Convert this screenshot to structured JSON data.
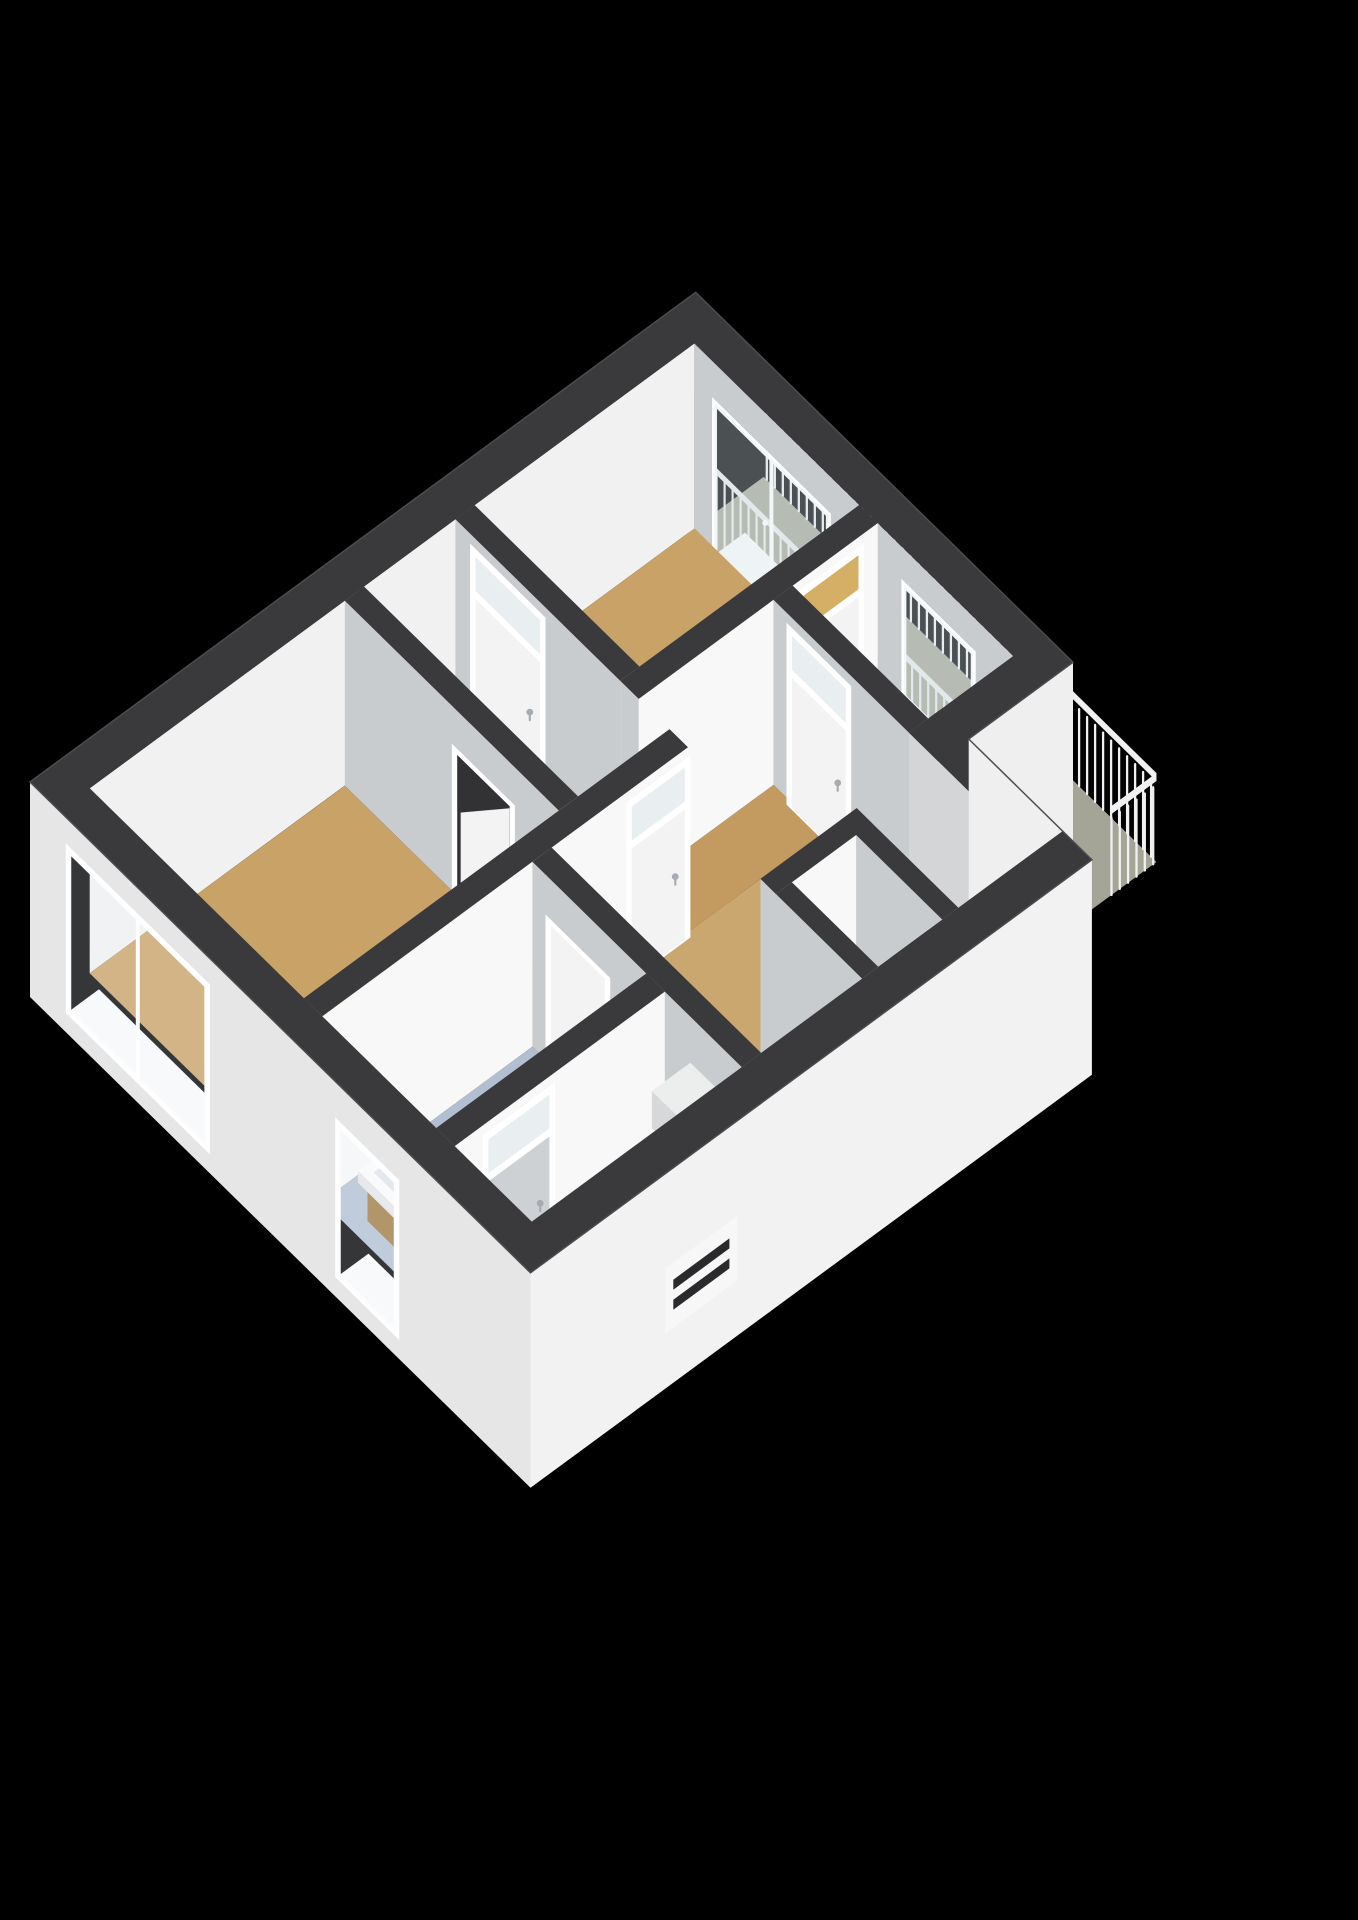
{
  "app": {
    "name": "3d-floorplan-isometric-view"
  },
  "canvas": {
    "width": 1358,
    "height": 1920,
    "background": "#000000"
  },
  "iso": {
    "x0": 30,
    "y0": 782,
    "ax": 0.802,
    "ay": -0.59,
    "bx": 0.77,
    "by": 0.755,
    "floorZ": 185,
    "baseZ": 215,
    "sillZ": 192,
    "balconyFloorZ": 195,
    "railTopZ": 112
  },
  "palette": {
    "bg": "#000000",
    "wallTop": "#3a3a3c",
    "outline": "#4c4c50",
    "extSW": "#e6e6e6",
    "extSE": "#f2f2f2",
    "extSE2": "#efefef",
    "intSE": "#f8f8f8",
    "intSW": "#c9ccce",
    "intSW2": "#d3d5d6",
    "intNW": "#f1f1f2",
    "wood": "#c9a267",
    "woodHall": "#c39b60",
    "woodKitchen": "#c9a76e",
    "tile": "#b2bfd3",
    "whiteFloor": "#f1f1f1",
    "closetFloor": "#9b9b9d",
    "balconyFloor": "#a5a597",
    "railing": "#f1f1f1",
    "railing2": "#e9eceb",
    "frame": "#ffffff",
    "sill": "#fafafa",
    "glassNE": "rgba(214,228,235,0.35)",
    "glassSW": "rgba(240,246,250,0.22)",
    "transomGlass": "#e9eef1",
    "amber": "#d6af67",
    "doorWhite": "#f3f3f3",
    "doorGray": "#cdd1d4",
    "gap": "#323235",
    "oak": "#b78b50",
    "oakDark": "#a17a41",
    "chrome": "#a6acb1",
    "boxWhite": "#eceded",
    "slabSlot": "#2a2a2c"
  },
  "plan": {
    "outline": [
      [
        0,
        0
      ],
      [
        830,
        0
      ],
      [
        830,
        490
      ],
      [
        700,
        490
      ],
      [
        700,
        650
      ],
      [
        0,
        650
      ]
    ],
    "ringT": 38,
    "floors": [
      {
        "name": "floor-bedroom-1",
        "rect": [
          518,
          38,
          792,
          252
        ],
        "color": "wood"
      },
      {
        "name": "floor-study",
        "rect": [
          686,
          276,
          792,
          452
        ],
        "color": "whiteFloor"
      },
      {
        "name": "floor-hall",
        "rect": [
          380,
          38,
          494,
          316
        ],
        "color": "woodHall"
      },
      {
        "name": "floor-hall-b",
        "rect": [
          494,
          276,
          662,
          340
        ],
        "color": "woodHall"
      },
      {
        "name": "floor-living-room",
        "rect": [
          38,
          38,
          356,
          316
        ],
        "color": "wood"
      },
      {
        "name": "floor-kitchen",
        "rect": [
          324,
          340,
          662,
          612
        ],
        "color": "woodKitchen"
      },
      {
        "name": "floor-washroom",
        "rect": [
          38,
          340,
          300,
          488
        ],
        "color": "tile"
      },
      {
        "name": "floor-shower-room",
        "rect": [
          38,
          512,
          300,
          612
        ],
        "color": "tile"
      },
      {
        "name": "floor-closet",
        "rect": [
          470,
          500,
          550,
          612
        ],
        "color": "closetFloor"
      }
    ],
    "sills": [
      {
        "name": "sill-living-window",
        "rect": [
          0,
          50,
          38,
          230
        ]
      },
      {
        "name": "sill-washroom-window",
        "rect": [
          0,
          400,
          38,
          476
        ]
      },
      {
        "name": "sill-balcony-door",
        "rect": [
          792,
          64,
          830,
          212
        ]
      },
      {
        "name": "sill-study-window",
        "rect": [
          792,
          310,
          830,
          400
        ]
      }
    ],
    "neRing": {
      "name": "wall-exterior-ne",
      "faceU": 792,
      "v0": 38,
      "v1": 452,
      "holes": [
        {
          "name": "balcony-door-opening",
          "a0": 64,
          "a1": 212,
          "z0": 40,
          "z1": 190,
          "mullion": 138
        },
        {
          "name": "study-window-opening",
          "a0": 310,
          "a1": 400,
          "z0": 36,
          "z1": 148,
          "mullion": null
        }
      ],
      "top": [
        792,
        0,
        830,
        490
      ]
    },
    "nwRing": {
      "name": "wall-exterior-nw",
      "faceV": 38,
      "u0": 38,
      "u1": 792,
      "top": [
        0,
        0,
        830,
        38
      ]
    },
    "seRingEast": {
      "name": "wall-exterior-se-east",
      "top": [
        662,
        452,
        830,
        490
      ],
      "faceV": 490,
      "u0": 700,
      "u1": 830
    },
    "seRingDeep": {
      "name": "wall-exterior-se-deep",
      "top": [
        0,
        612,
        700,
        650
      ],
      "faceV": 650,
      "u0": 0,
      "u1": 700
    },
    "swRing": {
      "name": "wall-exterior-sw",
      "top": [
        0,
        0,
        38,
        650
      ],
      "faceU": 0,
      "v0": 0,
      "v1": 650,
      "holes": [
        {
          "name": "living-window-opening",
          "a0": 50,
          "a1": 230,
          "z0": 30,
          "z1": 192,
          "mullion": 140
        },
        {
          "name": "washroom-window-opening",
          "a0": 400,
          "a1": 476,
          "z0": 40,
          "z1": 192,
          "mullion": null
        }
      ]
    },
    "walls": [
      {
        "name": "wall-bedroom1-hall",
        "top": [
          494,
          38,
          518,
          252
        ],
        "faces": [
          {
            "k": "f2",
            "c": 494,
            "a0": 38,
            "a1": 252,
            "fill": "intSW"
          },
          {
            "k": "f1",
            "c": 252,
            "a0": 494,
            "a1": 518,
            "fill": "intSE"
          }
        ],
        "doors": [
          {
            "face": "f2",
            "c": 494,
            "a0": 64,
            "a1": 148,
            "leaf": "doorWhite",
            "transom": "transomGlass",
            "handle": 0.84
          }
        ]
      },
      {
        "name": "wall-bedroom1-south",
        "top": [
          494,
          252,
          792,
          276
        ],
        "faces": [
          {
            "k": "f1",
            "c": 276,
            "a0": 494,
            "a1": 792,
            "fill": "intSE"
          },
          {
            "k": "f2",
            "c": 494,
            "a0": 252,
            "a1": 276,
            "fill": "intSW"
          }
        ],
        "doors": [
          {
            "face": "f1",
            "c": 276,
            "a0": 700,
            "a1": 768,
            "leaf": "doorWhite",
            "transom": "amber",
            "handle": 0.12
          }
        ]
      },
      {
        "name": "wall-study",
        "top": [
          662,
          276,
          686,
          452
        ],
        "faces": [
          {
            "k": "f2",
            "c": 662,
            "a0": 276,
            "a1": 452,
            "fill": "intSW"
          }
        ],
        "doors": [
          {
            "face": "f2",
            "c": 662,
            "a0": 300,
            "a1": 370,
            "leaf": "doorWhite",
            "transom": "transomGlass",
            "handle": 0.85
          }
        ]
      },
      {
        "name": "wall-living-hall",
        "top": [
          356,
          38,
          380,
          316
        ],
        "faces": [
          {
            "k": "f2",
            "c": 356,
            "a0": 38,
            "a1": 316,
            "fill": "intSW"
          },
          {
            "k": "f1",
            "c": 316,
            "a0": 356,
            "a1": 380,
            "fill": "intSE"
          }
        ],
        "openings": [
          {
            "face": "f2",
            "c": 356,
            "a0": 184,
            "a1": 252,
            "openLeaf": true
          }
        ]
      },
      {
        "name": "wall-notch-inner",
        "top": [
          662,
          452,
          700,
          650
        ],
        "faces": [
          {
            "k": "f2",
            "c": 662,
            "a0": 452,
            "a1": 612,
            "fill": "intSW2"
          }
        ]
      },
      {
        "name": "closet-wall-nw",
        "top": [
          450,
          480,
          570,
          500
        ],
        "faces": [
          {
            "k": "f1",
            "c": 500,
            "a0": 450,
            "a1": 570,
            "fill": "intSE"
          },
          {
            "k": "f2",
            "c": 450,
            "a0": 480,
            "a1": 500,
            "fill": "intSW"
          }
        ]
      },
      {
        "name": "closet-wall-ne",
        "top": [
          550,
          480,
          570,
          612
        ],
        "faces": [
          {
            "k": "f2",
            "c": 550,
            "a0": 500,
            "a1": 612,
            "fill": "intSW"
          }
        ]
      },
      {
        "name": "closet-wall-sw",
        "top": [
          450,
          500,
          470,
          612
        ],
        "faces": [
          {
            "k": "f2",
            "c": 450,
            "a0": 500,
            "a1": 612,
            "fill": "intSW"
          }
        ]
      },
      {
        "name": "wall-hall-kitchen",
        "top": [
          38,
          316,
          494,
          340
        ],
        "faces": [
          {
            "k": "f1",
            "c": 340,
            "a0": 38,
            "a1": 494,
            "fill": "intSE"
          }
        ],
        "doors": [
          {
            "face": "f1",
            "c": 340,
            "a0": 424,
            "a1": 490,
            "leaf": "doorWhite",
            "transom": "transomGlass",
            "handle": 0.82
          }
        ]
      },
      {
        "name": "wall-washroom-east",
        "top": [
          300,
          340,
          324,
          612
        ],
        "faces": [
          {
            "k": "f2",
            "c": 300,
            "a0": 340,
            "a1": 612,
            "fill": "intSW"
          }
        ],
        "doors": [
          {
            "face": "f2",
            "c": 300,
            "a0": 364,
            "a1": 434,
            "leaf": "doorWhite",
            "transom": null,
            "handle": 0.85
          }
        ]
      },
      {
        "name": "wall-washroom-divider",
        "top": [
          38,
          488,
          300,
          512
        ],
        "faces": [
          {
            "k": "f1",
            "c": 512,
            "a0": 38,
            "a1": 300,
            "fill": "intSE"
          }
        ],
        "doors": [
          {
            "face": "f1",
            "c": 512,
            "a0": 80,
            "a1": 156,
            "leaf": "doorGray",
            "transom": "transomGlass",
            "handle": 0.85
          }
        ]
      }
    ],
    "balcony": {
      "floor": [
        792,
        30,
        886,
        540
      ],
      "outerU": 886,
      "vRange": [
        34,
        538
      ],
      "endV": 540,
      "endU": [
        830,
        886
      ],
      "innerU": 800,
      "innerRanges": [
        [
          48,
          226
        ],
        [
          302,
          408
        ]
      ],
      "step": 10.4
    },
    "fixtures": {
      "whiteBox": {
        "name": "kitchen-unit-box",
        "rect": [
          326,
          468,
          374,
          502
        ],
        "z0": 148,
        "z1": 185
      },
      "vanity": {
        "name": "bathroom-vanity",
        "cab": [
          56,
          380,
          128,
          446
        ],
        "cabZ": [
          148,
          185
        ],
        "basin": [
          50,
          374,
          134,
          452
        ],
        "basinZ": [
          136,
          148
        ],
        "faucet": [
          92,
          382,
          124
        ]
      },
      "shower": {
        "name": "shower-set",
        "grab": [
          [
            70,
            598
          ],
          [
            160,
            598
          ],
          95
        ],
        "riser": [
          168,
          604,
          58,
          135
        ],
        "arm": [
          [
            164,
            602,
            75
          ],
          [
            128,
            584,
            90
          ]
        ],
        "head": [
          124,
          582,
          92
        ],
        "headR": 7.5
      },
      "slab": {
        "name": "facade-vent-slab",
        "v": 650,
        "u0": 168,
        "u1": 258,
        "z0": 95,
        "z1": 160,
        "slots": [
          [
            112,
            122
          ],
          [
            132,
            142
          ]
        ]
      }
    }
  }
}
